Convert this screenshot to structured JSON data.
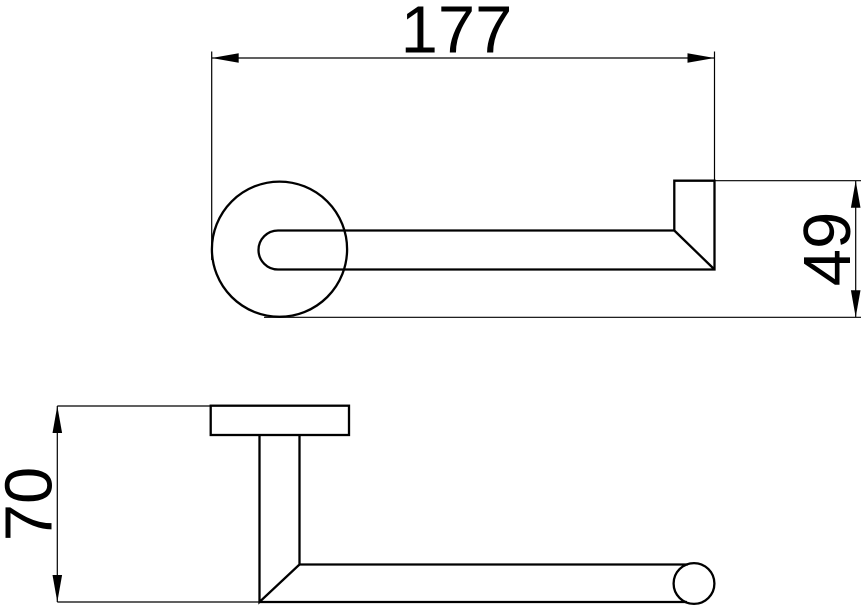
{
  "drawing": {
    "background_color": "#ffffff",
    "line_color": "#000000",
    "dimensions": {
      "overall_width": {
        "label": "177",
        "orientation": "horizontal",
        "view": "front"
      },
      "overall_height": {
        "label": "49",
        "orientation": "vertical",
        "view": "front"
      },
      "projection": {
        "label": "70",
        "orientation": "vertical",
        "view": "side"
      }
    }
  }
}
